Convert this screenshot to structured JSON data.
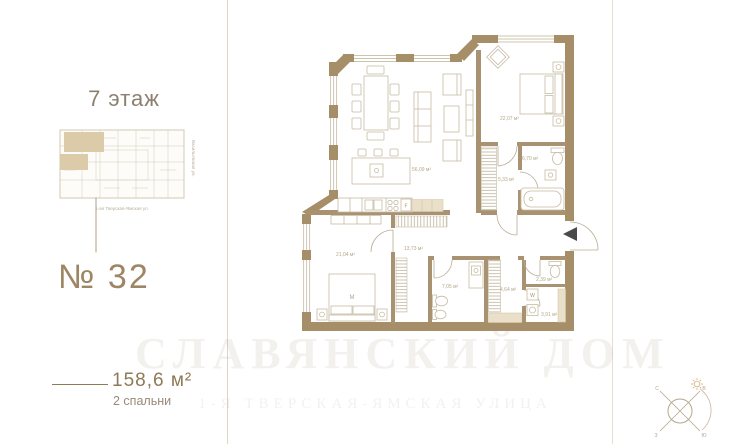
{
  "sidebar": {
    "floor_label": "7 этаж",
    "unit_number": "№ 32",
    "area_value": "158,6 м²",
    "bedrooms_value": "2 спальни",
    "minimap": {
      "street_right": "Васильевская ул.",
      "street_bottom": "1-ая Тверская-Ямская ул."
    }
  },
  "plan": {
    "rooms": [
      {
        "name": "living-dining-kitchen",
        "area": "56,09 м²"
      },
      {
        "name": "bedroom-2",
        "area": "22,07 м²"
      },
      {
        "name": "bathroom-2",
        "area": "6,70 м²"
      },
      {
        "name": "wardrobe-2",
        "area": "5,33 м²"
      },
      {
        "name": "bedroom-master",
        "area": "21,04 м²"
      },
      {
        "name": "hallway",
        "area": "13,73 м²"
      },
      {
        "name": "bathroom-1",
        "area": "7,05 м²"
      },
      {
        "name": "wardrobe-1",
        "area": "4,64 м²"
      },
      {
        "name": "wc",
        "area": "2,39 м²"
      },
      {
        "name": "laundry",
        "area": "3,91 м²"
      }
    ],
    "bed_label": "M",
    "washer_label": "W",
    "fridge_label": "F"
  },
  "watermark": {
    "line1": "СЛАВЯНСКИЙ ДОМ",
    "line2": "1-Я ТВЕРСКАЯ-ЯМСКАЯ УЛИЦА"
  },
  "compass": {
    "n": "С",
    "e": "В",
    "w": "З",
    "s": "Ю"
  },
  "colors": {
    "wall": "#a68f68",
    "interior_wall": "#a99271",
    "accent_text": "#8f7a57",
    "furniture_line": "#c6bba4",
    "label_text": "#b5a88c",
    "highlight_fill": "#dbcba9"
  }
}
